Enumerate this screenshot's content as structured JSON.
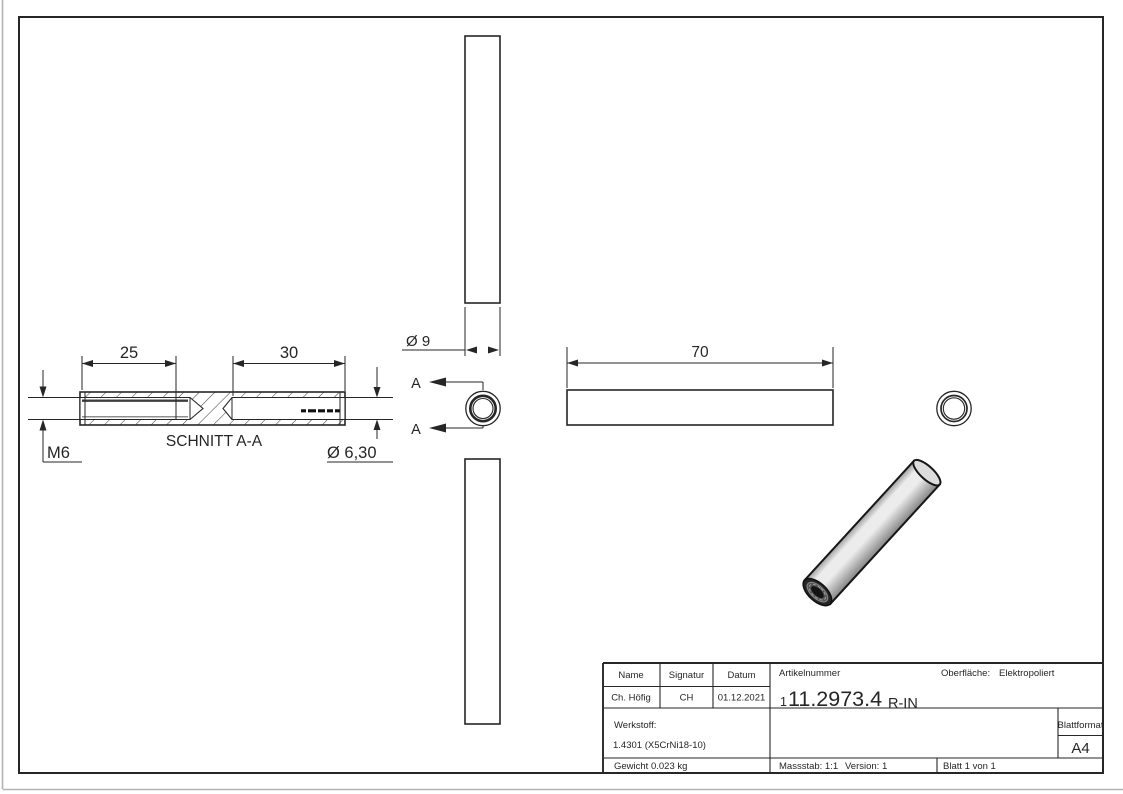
{
  "colors": {
    "line": "#262626",
    "page_edge": "#b3b3b3",
    "part_edge_shade": "#9e9e9e",
    "part_body_light": "#ececec",
    "part_body_dark": "#858585",
    "part_face": "#dcdcdc",
    "part_end_ring": "#262626",
    "part_thread_ring": "#555555",
    "part_hole": "#141414"
  },
  "drawing": {
    "section_view": {
      "label": "SCHNITT A-A",
      "dim_thread_length": "25",
      "dim_bore_depth": "30",
      "thread_size": "M6",
      "dim_bore_dia": "Ø 6,30"
    },
    "top_view": {
      "dim_outer_dia": "Ø 9"
    },
    "side_view": {
      "dim_length": "70"
    },
    "section_cut": {
      "mark": "A"
    }
  },
  "title_block": {
    "name_header": "Name",
    "signatur_header": "Signatur",
    "datum_header": "Datum",
    "name_value": "Ch. Höfig",
    "signatur_value": "CH",
    "datum_value": "01.12.2021",
    "artikelnummer_label": "Artikelnummer",
    "artikelnummer_prefix": "1",
    "artikelnummer_main": "11.2973.4",
    "artikelnummer_suffix": "R-IN",
    "oberflaeche_label": "Oberfläche:",
    "oberflaeche_value": "Elektropoliert",
    "werkstoff_label": "Werkstoff:",
    "werkstoff_value": "1.4301 (X5CrNi18-10)",
    "gewicht": "Gewicht 0.023 kg",
    "massstab": "Massstab: 1:1",
    "version": "Version: 1",
    "blatt": "Blatt 1 von 1",
    "blattformat_label": "Blattformat",
    "blattformat_value": "A4"
  }
}
